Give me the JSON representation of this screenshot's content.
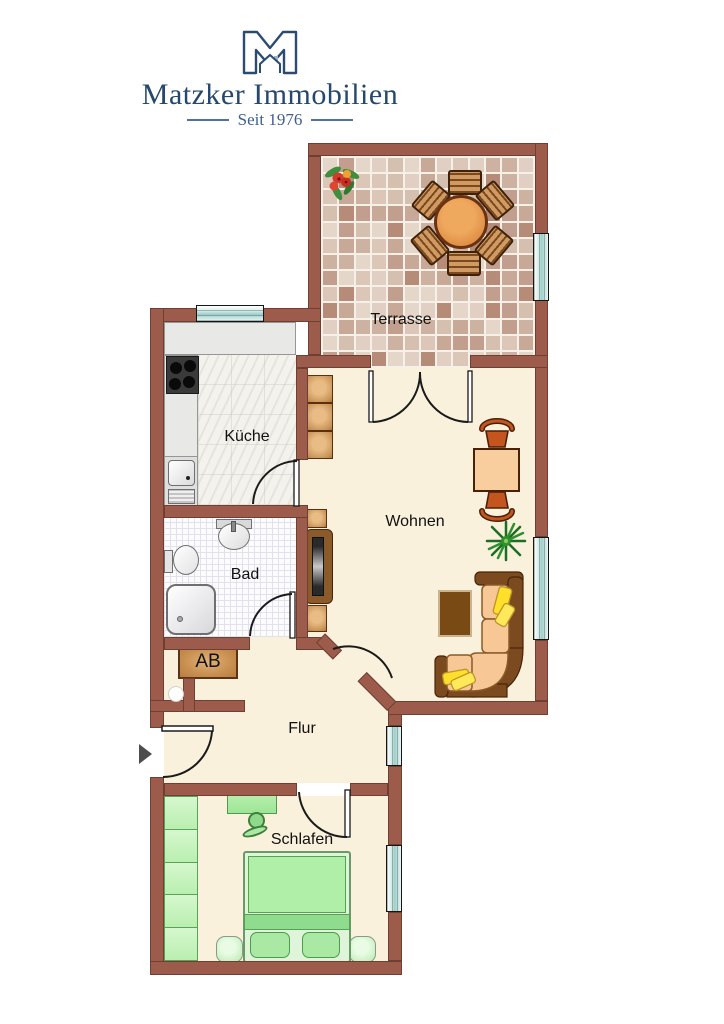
{
  "logo": {
    "icon": "matzker-m-house-logo",
    "title": "Matzker Immobilien",
    "tagline": "Seit 1976"
  },
  "floorplan": {
    "rooms": [
      {
        "id": "terrasse",
        "label": "Terrasse"
      },
      {
        "id": "kueche",
        "label": "Küche"
      },
      {
        "id": "wohnen",
        "label": "Wohnen"
      },
      {
        "id": "bad",
        "label": "Bad"
      },
      {
        "id": "abstellraum",
        "label": "AB"
      },
      {
        "id": "flur",
        "label": "Flur"
      },
      {
        "id": "schlafen",
        "label": "Schlafen"
      }
    ],
    "entrance_marker": "right-pointing-arrow",
    "colors": {
      "logo_navy": "#2B4B72",
      "tagline_blue": "#3F608C",
      "wall": "#9D5B4C",
      "wall_outline": "#6E4033",
      "floor_cream": "#F9F1DC",
      "terrace_grout": "#F6F1E8",
      "tile_palette": [
        "#DCC6B8",
        "#CDB1A1",
        "#C19E8D",
        "#B68C79",
        "#E4D6C9",
        "#D5BFAF",
        "#C8A896",
        "#E0CFC2"
      ],
      "window_pane": "#9ECFCA",
      "furniture_wood": "#C8925A",
      "sofa_brown": "#7B4A1F",
      "sofa_cushion": "#F7C795",
      "pillow_yellow": "#FFDF2B",
      "bedroom_green": "#AFEFA8",
      "label_color": "#111111"
    }
  }
}
